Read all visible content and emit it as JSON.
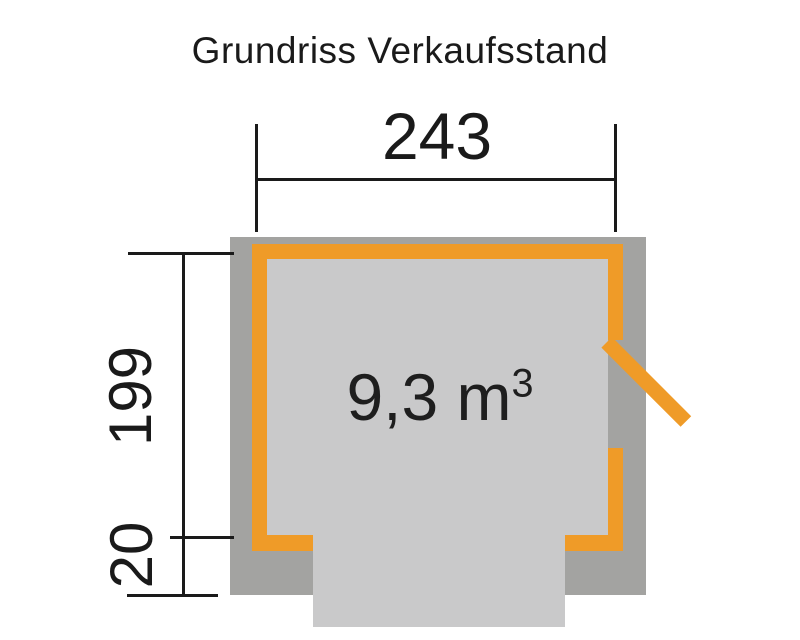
{
  "page": {
    "title": "Grundriss Verkaufsstand"
  },
  "colors": {
    "wall_orange": "#ef9b28",
    "overhang_gray": "#a3a3a1",
    "floor_gray": "#c9c9ca",
    "line_black": "#1a1a1a"
  },
  "dimensions": {
    "width": {
      "label": "243"
    },
    "depth": {
      "label": "199"
    },
    "overhang": {
      "label": "20"
    }
  },
  "room": {
    "volume": "9,3 m",
    "volume_exponent": "3"
  }
}
